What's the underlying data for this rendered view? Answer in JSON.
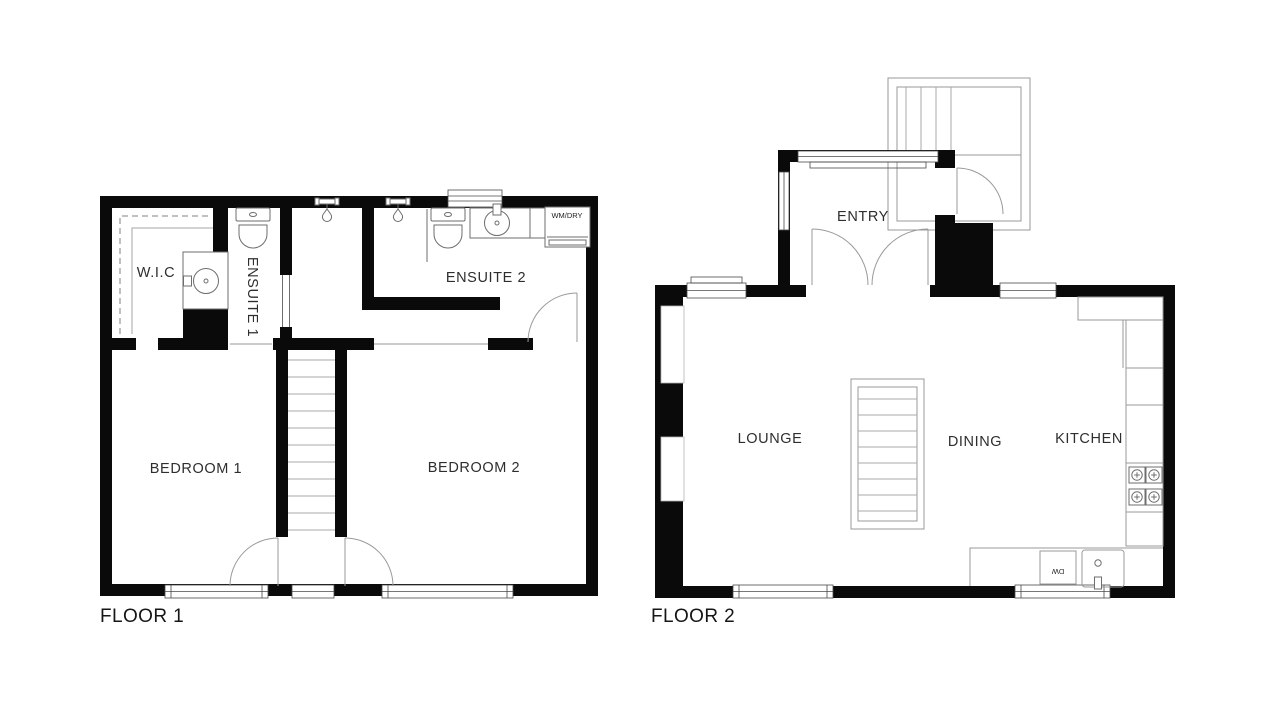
{
  "colors": {
    "bg": "#ffffff",
    "wall": "#0a0a0a",
    "fixture": "#6e6e6e",
    "door": "#9a9a9a",
    "stair": "#a8a8a8",
    "window": "#4a4a4a",
    "text": "#2e2e2e"
  },
  "floor1": {
    "label": "FLOOR 1",
    "rooms": {
      "wic": "W.I.C",
      "ensuite1": "ENSUITE 1",
      "ensuite2": "ENSUITE 2",
      "bedroom1": "BEDROOM 1",
      "bedroom2": "BEDROOM 2"
    },
    "appliances": {
      "washer_dryer": "WM/DRY"
    }
  },
  "floor2": {
    "label": "FLOOR 2",
    "rooms": {
      "entry": "ENTRY",
      "lounge": "LOUNGE",
      "dining": "DINING",
      "kitchen": "KITCHEN"
    },
    "appliances": {
      "dishwasher": "DW"
    }
  }
}
